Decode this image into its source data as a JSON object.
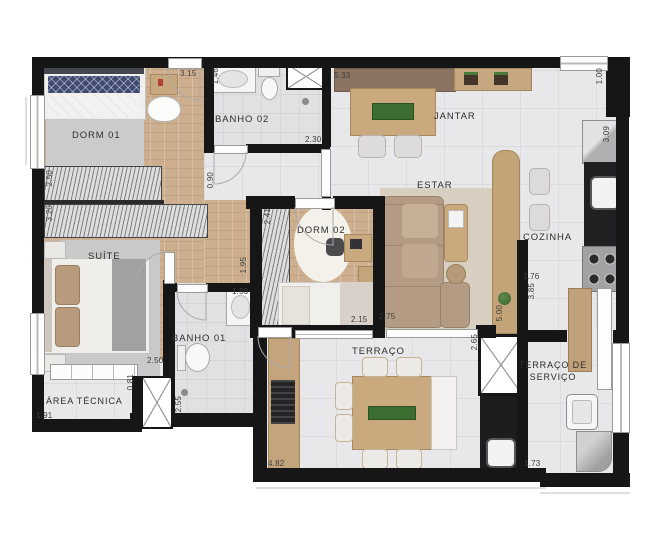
{
  "plan": {
    "type": "apartment-floor-plan",
    "rooms": [
      {
        "label": "DORM 01"
      },
      {
        "label": "BANHO 02"
      },
      {
        "label": "JANTAR"
      },
      {
        "label": "ESTAR"
      },
      {
        "label": "COZINHA"
      },
      {
        "label": "DORM 02"
      },
      {
        "label": "SUÍTE"
      },
      {
        "label": "BANHO 01"
      },
      {
        "label": "ÁREA TÉCNICA"
      },
      {
        "label": "TERRAÇO"
      },
      {
        "label": "TERRAÇO DE SERVIÇO"
      }
    ],
    "dimensions": [
      {
        "value": "3.15"
      },
      {
        "value": "1.46"
      },
      {
        "value": "2.30"
      },
      {
        "value": "5.33"
      },
      {
        "value": "1.00"
      },
      {
        "value": "3.09"
      },
      {
        "value": "0.90"
      },
      {
        "value": "2.50"
      },
      {
        "value": "3.20"
      },
      {
        "value": "2.41"
      },
      {
        "value": "1.95"
      },
      {
        "value": "1.50"
      },
      {
        "value": "2.50"
      },
      {
        "value": "0.81"
      },
      {
        "value": "2.55"
      },
      {
        "value": "1.91"
      },
      {
        "value": "2.15"
      },
      {
        "value": "2.75"
      },
      {
        "value": "1.76"
      },
      {
        "value": "3.85"
      },
      {
        "value": "5.00"
      },
      {
        "value": "2.65"
      },
      {
        "value": "4.82"
      },
      {
        "value": "1.73"
      }
    ],
    "colors": {
      "wall": "#161616",
      "wood_floor": "#cdaf8f",
      "tile_floor": "#e8e8ea",
      "furniture_wood": "#c9a97d",
      "sofa": "#b49c84",
      "plant_green": "#4c7a3d",
      "bed_navy": "#3e4a72"
    }
  }
}
